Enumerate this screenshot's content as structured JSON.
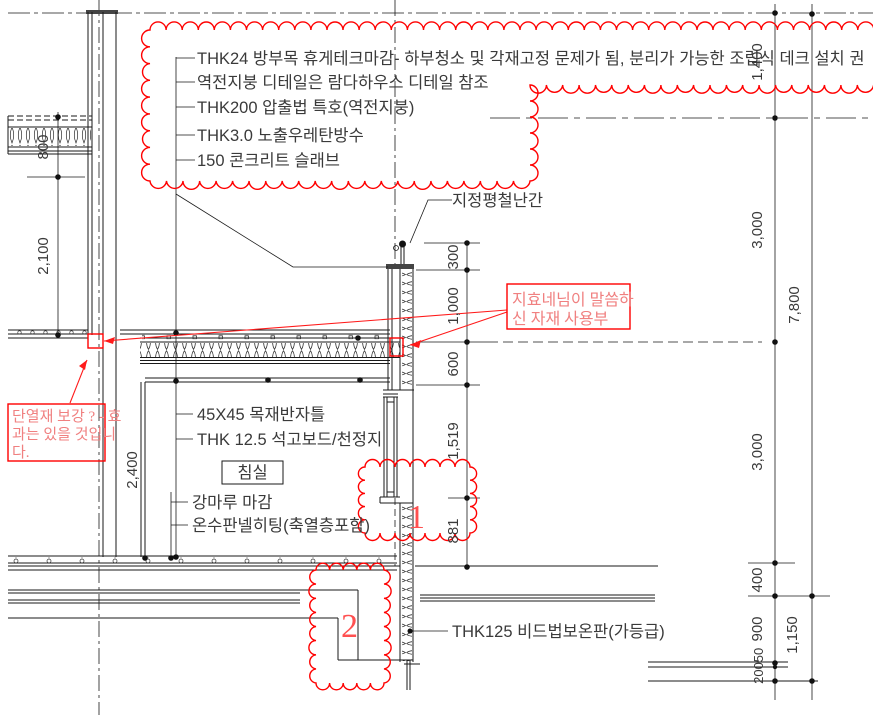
{
  "callouts": {
    "roof_stack": [
      "THK24 방부목 휴게테크마감- 하부청소 및 각재고정 문제가 됨, 분리가 가능한 조립식 데크 설치 권",
      "역전지붕 디테일은 람다하우스 디테일 참조",
      "THK200 압출법 특호(역전지붕)",
      "THK3.0 노출우레탄방수",
      "150 콘크리트 슬래브"
    ],
    "railing": "지정평철난간",
    "ceiling_frame": "45X45 목재반자틀",
    "ceiling_board": "THK 12.5 석고보드/천정지",
    "room": "침실",
    "floor_finish": "강마루 마감",
    "floor_heating": "온수판넬히팅(축열층포함)",
    "wall_insulation": "THK125 비드법보온판(가등급)"
  },
  "annotations": {
    "material_note_line1": "지효네님이 말씀하",
    "material_note_line2": "신 자재 사용부",
    "insul_note_line1": "단열재 보강 ? - 효",
    "insul_note_line2": "과는 있을 것입니",
    "insul_note_line3": "다.",
    "detail_no_1": "1",
    "detail_no_2": "2"
  },
  "dimensions": {
    "left_800": "800",
    "left_2100": "2,100",
    "left_2400": "2,400",
    "mid_300": "300",
    "mid_1000": "1,000",
    "mid_600": "600",
    "mid_1519": "1,519",
    "mid_881": "881",
    "right_1400": "1,400",
    "right_3000a": "3,000",
    "right_3000b": "3,000",
    "right_400": "400",
    "right_900": "900",
    "right_50": "50",
    "right_200": "200",
    "outer_7800": "7,800",
    "outer_1150": "1,150"
  },
  "colors": {
    "linework": "#1a1a1a",
    "revision_cloud": "#ff0000",
    "note_text": "#f08080",
    "label_text": "#3a3a3a",
    "background": "#ffffff"
  }
}
